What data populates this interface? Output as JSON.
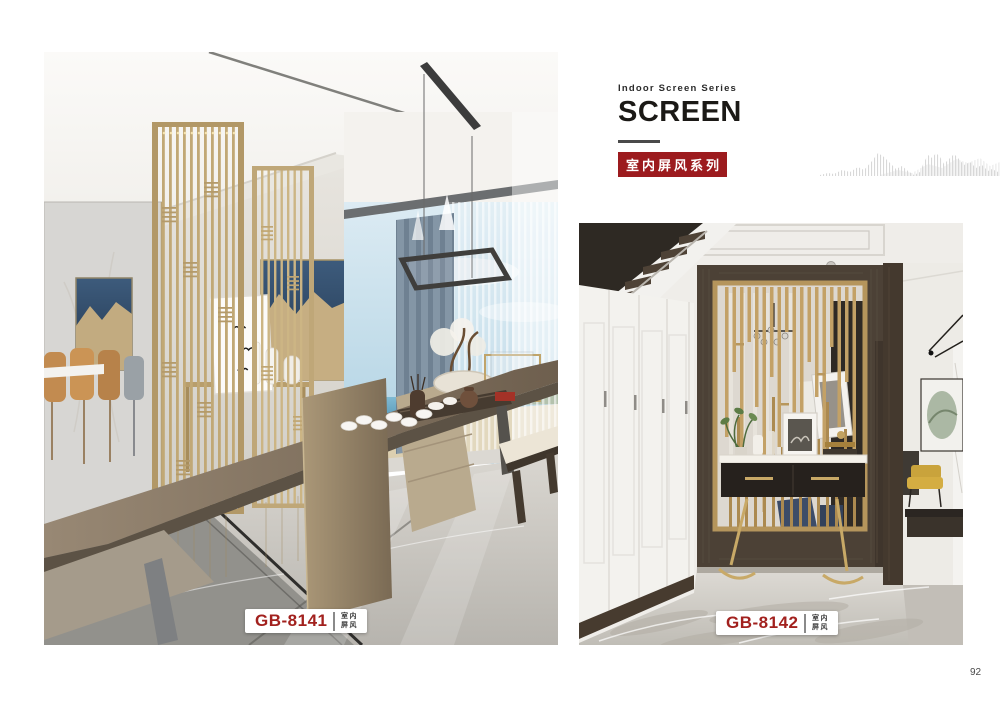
{
  "header": {
    "series_en": "Indoor Screen Series",
    "title": "SCREEN",
    "series_zh": "室内屏风系列"
  },
  "products": [
    {
      "code": "GB-8141",
      "category": [
        "室内",
        "屏风"
      ]
    },
    {
      "code": "GB-8142",
      "category": [
        "室内",
        "屏风"
      ]
    }
  ],
  "page_number": "92",
  "colors": {
    "accent_red": "#9c1b1e",
    "code_red": "#a2211e",
    "screen_gold": "#b99f6e",
    "wood_dark": "#4c4136"
  }
}
